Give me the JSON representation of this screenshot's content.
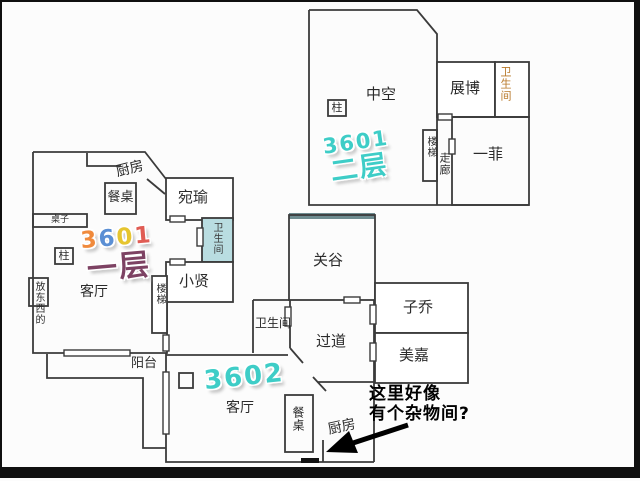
{
  "titles": {
    "floor1": {
      "digits": [
        "3",
        "6",
        "0",
        "1"
      ],
      "digit_colors": [
        "#f08a3c",
        "#5b8fd4",
        "#e6c52f",
        "#e05c54"
      ],
      "floor": "一层",
      "floor_color": "#7d4263"
    },
    "floor2": {
      "number": "3601",
      "floor": "二层",
      "color": "#3ecdc7"
    },
    "apt2": {
      "number": "3602",
      "color": "#3ecdc7"
    }
  },
  "plan_upper": {
    "rooms": {
      "zhongkong": "中空",
      "zhanbo": "展博",
      "bathroom": "卫生间",
      "yifei": "一菲"
    },
    "features": {
      "pillar": "柱",
      "stairs": "楼梯",
      "corridor": "走廊"
    }
  },
  "plan_left": {
    "rooms": {
      "kitchen": "厨房",
      "wanyu": "宛瑜",
      "bathroom": "卫生间",
      "xiaoxian": "小贤",
      "living": "客厅"
    },
    "features": {
      "dining_table": "餐桌",
      "table": "桌子",
      "pillar": "柱",
      "stairs": "楼梯",
      "storage": "放东西的"
    }
  },
  "plan_lower": {
    "rooms": {
      "bathroom": "卫生间",
      "hallway": "过道",
      "guangu": "关谷",
      "ziqiao": "子乔",
      "meijia": "美嘉",
      "living": "客厅",
      "kitchen": "厨房"
    },
    "features": {
      "dining_table": "餐桌",
      "balcony": "阳台"
    }
  },
  "annotation": {
    "line1": "这里好像",
    "line2": "有个杂物间?"
  },
  "colors": {
    "wall": "#3b3b3b",
    "bathroom_fill": "#b9dde1",
    "guangu_top_shade": "#6e8c90",
    "title_cyan": "#3ecdc7",
    "title_plum": "#7d4263",
    "bathroom_text_orange": "#b8792a",
    "annotation_text": "#000000"
  }
}
